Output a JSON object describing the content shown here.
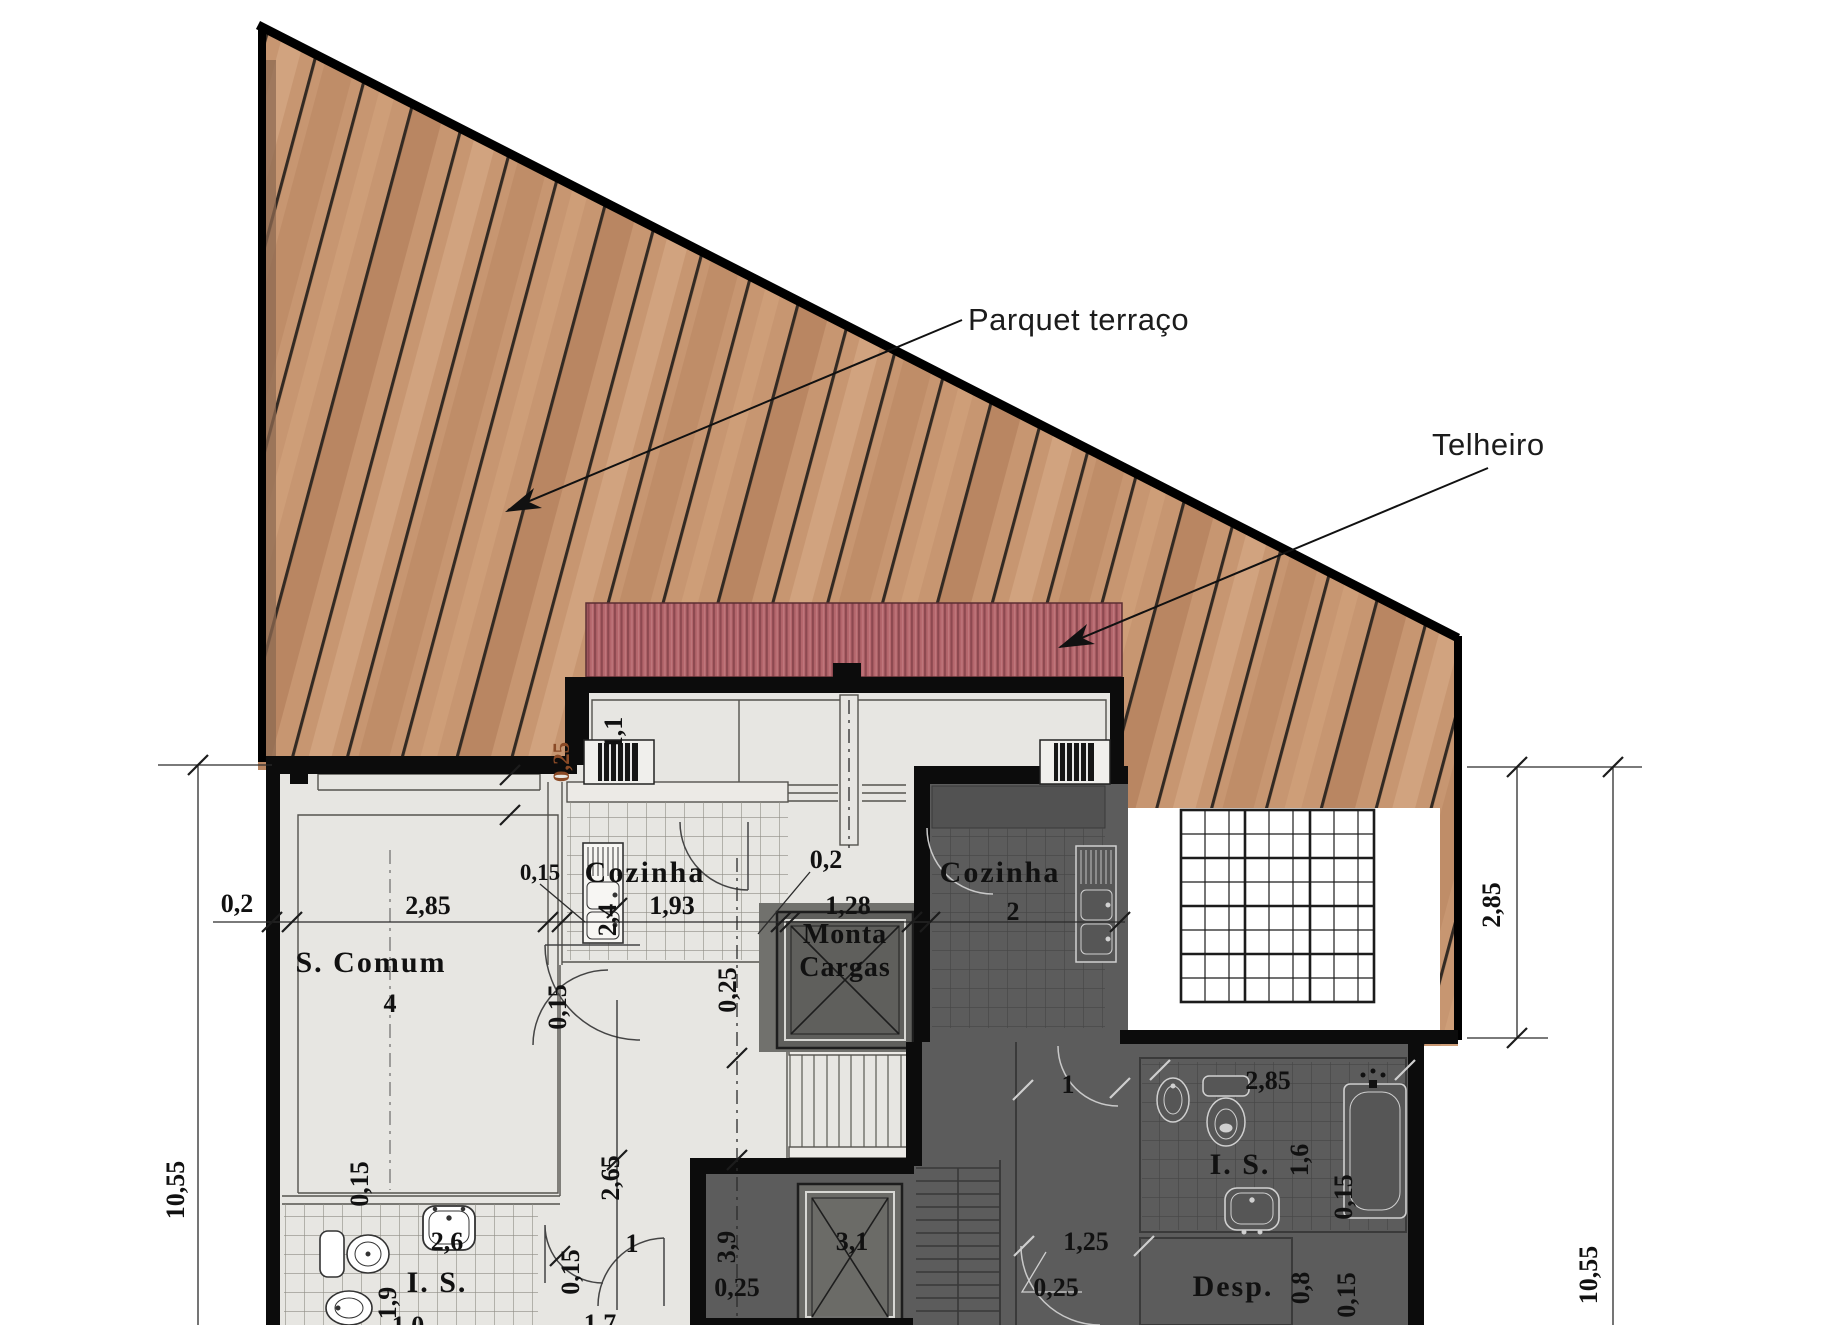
{
  "leaders": {
    "parquet": "Parquet terraço",
    "telheiro": "Telheiro"
  },
  "rooms": {
    "s_comum": "S. Comum",
    "cozinha_left": "Cozinha",
    "monta_line1": "Monta",
    "monta_line2": "Cargas",
    "cozinha_right": "Cozinha",
    "is_left": "I. S.",
    "is_right": "I. S.",
    "desp": "Desp."
  },
  "dims": {
    "wall_left": "0,2",
    "scomum_width": "2,85",
    "scomum_depth": "4",
    "kitchen_wall": "0,15",
    "kitchen_width": "1,93",
    "kitchen_depth": "2,4",
    "monta_wall": "0,2",
    "monta_width": "1,28",
    "top_window": "1,1",
    "top_wall": "0,25",
    "mid_wall_v": "0,25",
    "kitchen_wall_s": "0,15",
    "corridor": "2,65",
    "corridor_door": "1",
    "corridor_wall": "0,15",
    "is_left_wall": "0,15",
    "is_left_sink": "2,6",
    "is_left_depth": "1,9",
    "stair_run": "3,9",
    "stair_wall": "0,25",
    "elevator": "3,1",
    "dark_hall_door": "1",
    "dark_kitchen": "2",
    "dark_door": "1,25",
    "dark_wall": "0,25",
    "is_right_width": "2,85",
    "is_right_depth": "1,6",
    "is_right_wall_a": "0,15",
    "desp_width": "0,8",
    "is_right_wall_b": "0,15",
    "height_left": "10,55",
    "deck_right": "2,85",
    "height_right": "10,55",
    "bottom_a": "1,0",
    "bottom_b": "1,7"
  }
}
